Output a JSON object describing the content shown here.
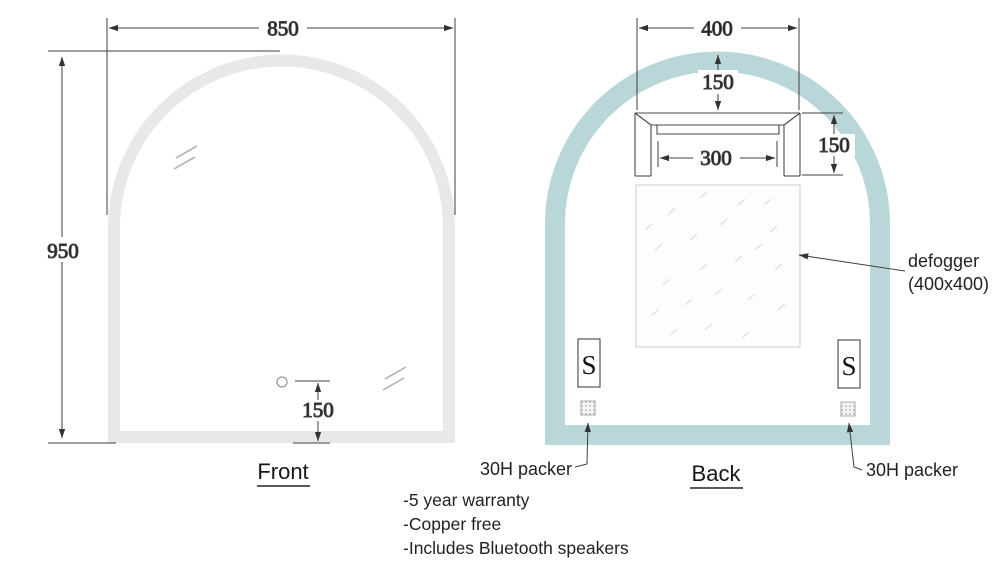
{
  "front": {
    "caption": "Front",
    "width_label": "850",
    "height_label": "950",
    "sensor_offset_label": "150"
  },
  "back": {
    "caption": "Back",
    "width_label": "400",
    "top_offset_label": "150",
    "bracket_inner_label": "300",
    "bracket_height_label": "150",
    "defogger": {
      "line1": "defogger",
      "line2": "(400x400)"
    },
    "speakers": {
      "left": "S",
      "right": "S"
    },
    "packers": {
      "left_label": "30H packer",
      "right_label": "30H packer"
    }
  },
  "notes": [
    "-5 year warranty",
    "-Copper free",
    "-Includes Bluetooth speakers"
  ],
  "colors": {
    "front_frame": "#e8e8e8",
    "back_frame": "#b9d6d8",
    "line": "#3f3f3f",
    "text": "#1c1c1c"
  }
}
